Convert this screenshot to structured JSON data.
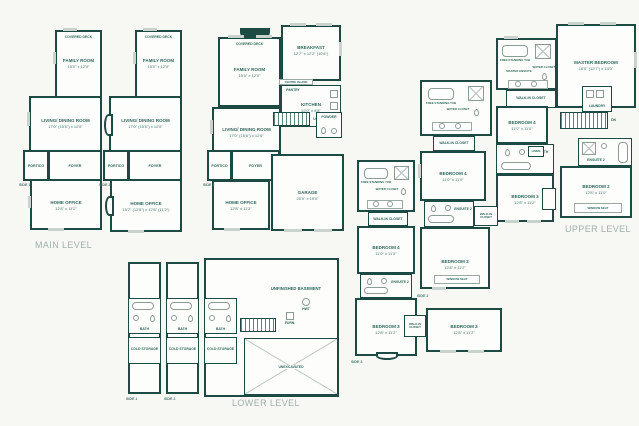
{
  "palette": {
    "wall": "#1d4a42",
    "room_text": "#2e675c",
    "title_text": "#a0afa9",
    "window": "#c9d2cc",
    "fixture": "#8a9c95",
    "background": "#f7f8f4"
  },
  "titles": {
    "main": "MAIN LEVEL",
    "lower": "LOWER LEVEL",
    "upper": "UPPER LEVEL"
  },
  "sides": {
    "s1": "SIDE 1",
    "s2": "SIDE 2",
    "s3": "SIDE 3"
  },
  "main": {
    "family_room": {
      "name": "FAMILY ROOM",
      "dim": "15'0\" x 12'0\""
    },
    "covered_deck": "COVERED DECK",
    "living_dining": {
      "name": "LIVING/ DINING ROOM",
      "dim": "17'0\" (15'6\") x 12'6\""
    },
    "portico": "PORTICO",
    "foyer": "FOYER",
    "powder": "POWDER",
    "pantry": "PANTRY",
    "home_office": {
      "name": "HOME OFFICE",
      "dim": "12'8\" x 11'2\""
    },
    "home_office_alt": {
      "name": "HOME OFFICE",
      "dim": "15'7\" (12'8\") x 12'6\" (11'2\")"
    },
    "breakfast": {
      "name": "BREAKFAST",
      "dim": "12'7\" x 12'2\" (10'8\")"
    },
    "kitchen": {
      "name": "KITCHEN",
      "dim": "12'0\" x 8'8\""
    },
    "centre_island": "CENTRE ISLAND",
    "garage": {
      "name": "GARAGE",
      "dim": "20'0\" x 19'0\""
    },
    "up": "UP"
  },
  "lower": {
    "bath": "BATH",
    "cold_storage": "COLD STORAGE",
    "unfinished_basement": "UNFINISHED BASEMENT",
    "unexcavated": "UNEXCAVATED",
    "hwt": "HWT",
    "furn": "FURN."
  },
  "upper": {
    "master_bedroom": {
      "name": "MASTER BEDROOM",
      "dim": "16'0\" (12'7\") x 14'0\""
    },
    "master_ensuite": "MASTER ENSUITE",
    "free_standing_tub": "FREE STANDING TUB",
    "water_closet": "WATER CLOSET",
    "walk_in_closet": "WALK-IN CLOSET",
    "laundry": "LAUNDRY",
    "linen": "LINEN",
    "bedroom2": {
      "name": "BEDROOM 2",
      "dim": "12'8\" x 11'0\""
    },
    "bedroom3": {
      "name": "BEDROOM 3",
      "dim": "12'8\" x 11'2\""
    },
    "bedroom4": {
      "name": "BEDROOM 4",
      "dim": "11'0\" x 11'0\""
    },
    "ensuite2": "ENSUITE 2",
    "main_bath": "MAIN BATH",
    "window_seat": "WINDOW SEAT",
    "dn": "DN"
  }
}
